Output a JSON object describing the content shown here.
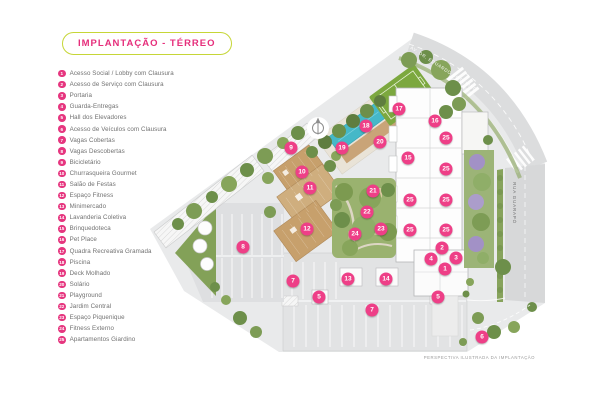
{
  "title": "IMPLANTAÇÃO - TÉRREO",
  "legend": {
    "items": [
      {
        "num": "1",
        "label": "Acesso Social / Lobby com Clausura"
      },
      {
        "num": "2",
        "label": "Acesso de Serviço com Clausura"
      },
      {
        "num": "3",
        "label": "Portaria"
      },
      {
        "num": "4",
        "label": "Guarda-Entregas"
      },
      {
        "num": "5",
        "label": "Hall dos Elevadores"
      },
      {
        "num": "6",
        "label": "Acesso de Veículos com Clausura"
      },
      {
        "num": "7",
        "label": "Vagas Cobertas"
      },
      {
        "num": "8",
        "label": "Vagas Descobertas"
      },
      {
        "num": "9",
        "label": "Bicicletário"
      },
      {
        "num": "10",
        "label": "Churrasqueira Gourmet"
      },
      {
        "num": "11",
        "label": "Salão de Festas"
      },
      {
        "num": "12",
        "label": "Espaço Fitness"
      },
      {
        "num": "13",
        "label": "Minimercado"
      },
      {
        "num": "14",
        "label": "Lavanderia Coletiva"
      },
      {
        "num": "15",
        "label": "Brinquedoteca"
      },
      {
        "num": "16",
        "label": "Pet Place"
      },
      {
        "num": "17",
        "label": "Quadra Recreativa Gramada"
      },
      {
        "num": "18",
        "label": "Piscina"
      },
      {
        "num": "19",
        "label": "Deck Molhado"
      },
      {
        "num": "20",
        "label": "Solário"
      },
      {
        "num": "21",
        "label": "Playground"
      },
      {
        "num": "22",
        "label": "Jardim Central"
      },
      {
        "num": "23",
        "label": "Espaço Piquenique"
      },
      {
        "num": "24",
        "label": "Fitness Externo"
      },
      {
        "num": "25",
        "label": "Apartamentos Giardino"
      }
    ]
  },
  "plan": {
    "avenue_label": "AV. DR. EDUARDO COTCHING",
    "street_label": "RUA GUARAPÓ",
    "caption": "PERSPECTIVA ILUSTRADA DA IMPLANTAÇÃO",
    "markers": [
      {
        "num": "1",
        "x": 445,
        "y": 269
      },
      {
        "num": "2",
        "x": 442,
        "y": 248
      },
      {
        "num": "3",
        "x": 456,
        "y": 258
      },
      {
        "num": "4",
        "x": 431,
        "y": 259
      },
      {
        "num": "5",
        "x": 319,
        "y": 297
      },
      {
        "num": "5",
        "x": 438,
        "y": 297
      },
      {
        "num": "6",
        "x": 482,
        "y": 337
      },
      {
        "num": "7",
        "x": 293,
        "y": 281
      },
      {
        "num": "7",
        "x": 372,
        "y": 310
      },
      {
        "num": "8",
        "x": 243,
        "y": 247
      },
      {
        "num": "9",
        "x": 291,
        "y": 148
      },
      {
        "num": "10",
        "x": 302,
        "y": 172
      },
      {
        "num": "11",
        "x": 310,
        "y": 188
      },
      {
        "num": "12",
        "x": 307,
        "y": 229
      },
      {
        "num": "13",
        "x": 348,
        "y": 279
      },
      {
        "num": "14",
        "x": 386,
        "y": 279
      },
      {
        "num": "15",
        "x": 408,
        "y": 158
      },
      {
        "num": "16",
        "x": 435,
        "y": 121
      },
      {
        "num": "17",
        "x": 399,
        "y": 109
      },
      {
        "num": "18",
        "x": 366,
        "y": 126
      },
      {
        "num": "19",
        "x": 342,
        "y": 148
      },
      {
        "num": "20",
        "x": 380,
        "y": 142
      },
      {
        "num": "21",
        "x": 373,
        "y": 191
      },
      {
        "num": "22",
        "x": 367,
        "y": 212
      },
      {
        "num": "23",
        "x": 381,
        "y": 229
      },
      {
        "num": "24",
        "x": 355,
        "y": 234
      },
      {
        "num": "25",
        "x": 446,
        "y": 138
      },
      {
        "num": "25",
        "x": 446,
        "y": 169
      },
      {
        "num": "25",
        "x": 410,
        "y": 200
      },
      {
        "num": "25",
        "x": 446,
        "y": 200
      },
      {
        "num": "25",
        "x": 410,
        "y": 230
      },
      {
        "num": "25",
        "x": 446,
        "y": 230
      }
    ],
    "colors": {
      "accent_pink": "#e62e7b",
      "marker_pink": "#ee3f87",
      "pill_border": "#c6d637",
      "legend_text": "#707070",
      "pool_teal": "#45b8c8",
      "field_green": "#7ca83f",
      "wood_tan": "#c7a06c",
      "street_gray": "#d7d8d9"
    }
  }
}
